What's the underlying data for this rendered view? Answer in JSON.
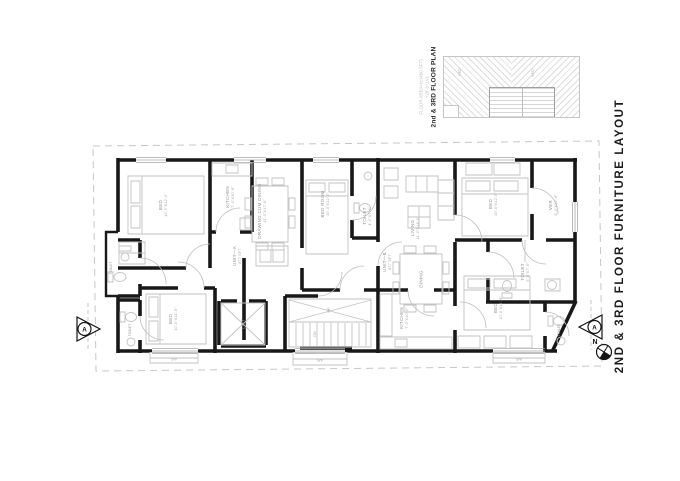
{
  "drawing": {
    "title": "2ND & 3RD  FLOOR FURNITURE LAYOUT",
    "north_label": "N",
    "section_label_left": "A",
    "section_label_right": "A"
  },
  "key_plan": {
    "title": "2nd & 3RD  FLOOR PLAN",
    "area_text": "FLOOR AREA=(±1450 SFT)",
    "level_text": "+28'-6\" LVL",
    "tiny_label_1": "BED",
    "tiny_label_2": "BED"
  },
  "units": {
    "a_label": "UNIT—A",
    "a_area": "877 SFT",
    "b_label": "UNIT—B",
    "b_area": "877 SFT"
  },
  "rooms": {
    "bed_tl": {
      "name": "BED",
      "dims": "10'-0\"X12'-0\""
    },
    "kitchen_a": {
      "name": "KITCHEN",
      "dims": "7'-0\"X10'-6\""
    },
    "drawing_dining": {
      "name": "DRAWING CUM DINING",
      "dims": "11'-0\"X17'-6\""
    },
    "bed_mid": {
      "name": "BED ROOM",
      "dims": "10'-0\"X12'-0\""
    },
    "toilet_a": {
      "name": "TOILET",
      "dims": "4'-0\"X7'-0\""
    },
    "toilet_left": {
      "name": "TOILET",
      "dims": "4'-0\"X7'-6\""
    },
    "bed_bl": {
      "name": "BED",
      "dims": "10'-0\"X11'-6\""
    },
    "toilet_bl": {
      "name": "TOILET"
    },
    "lift": {
      "name": "LIFT"
    },
    "stair": {
      "up": "UP",
      "dn": "DN"
    },
    "living": {
      "name": "LIVING",
      "dims": "11'-0\"X14'-0\""
    },
    "dining_b": {
      "name": "DINING"
    },
    "kitchen_b": {
      "name": "KITCHEN",
      "dims": "7'-0\"X10'-0\""
    },
    "bed_tr": {
      "name": "BED",
      "dims": "10'-0\"X12'-0\""
    },
    "ver": {
      "name": "VER",
      "dims": "3'-0\"X12'-6\""
    },
    "toilet_b": {
      "name": "TOILET",
      "dims": "5'-0\"X7'-6\""
    },
    "bed_br": {
      "name": "BED",
      "dims": "10'-0\"X11'-6\""
    },
    "toilet_br": {
      "name": "TOILET"
    },
    "balcony_left": {
      "name": "S/V"
    },
    "balcony_mid": {
      "name": "S/V"
    },
    "balcony_right": {
      "name": "S/V"
    }
  }
}
